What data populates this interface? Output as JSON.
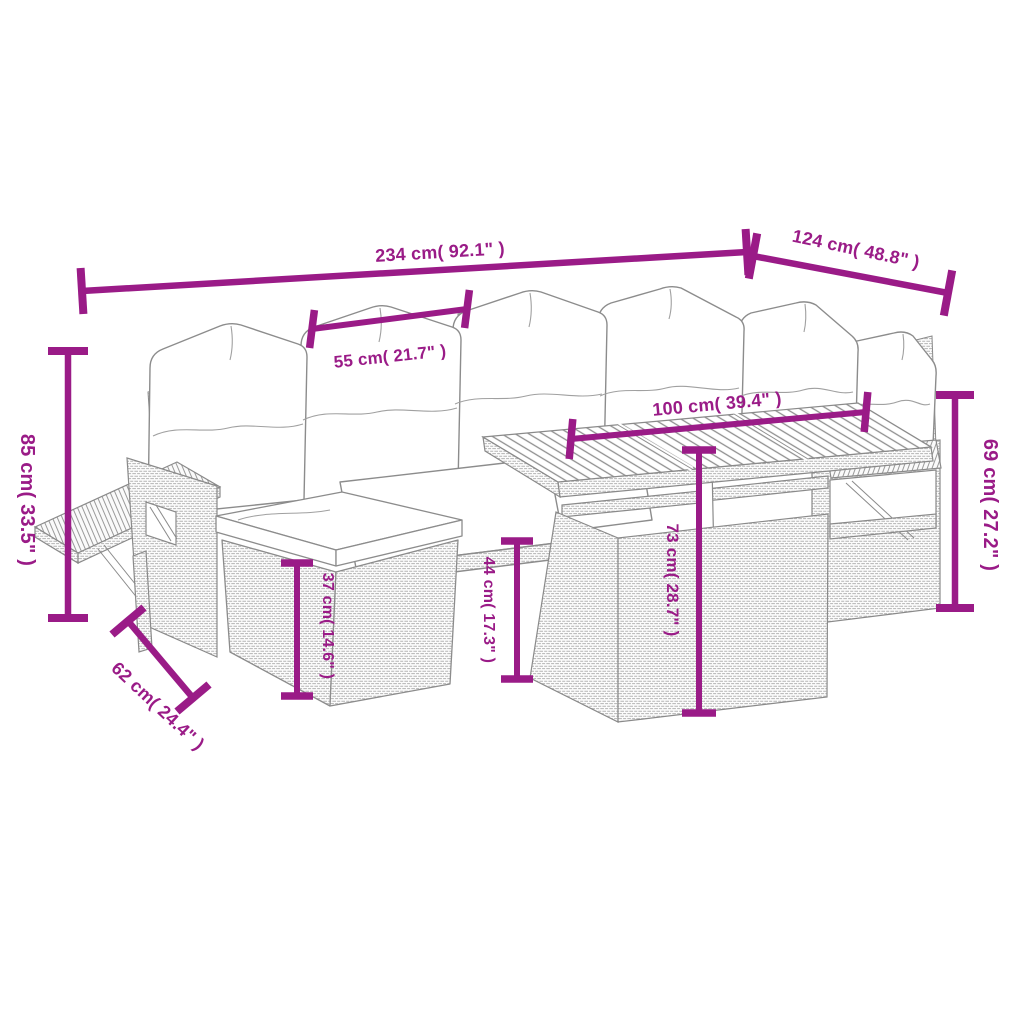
{
  "image": {
    "kind": "product dimension diagram",
    "subject": "line drawing of a poly rattan garden lounge set with back cushions, seat cushions, footstool and wood-slat table",
    "background_color": "#ffffff",
    "line_art_color": "#8a8a8a",
    "accent_color": "#9a1b87"
  },
  "dimensions": [
    {
      "name": "overall-width",
      "label": "234 cm( 92.1\" )"
    },
    {
      "name": "overall-depth",
      "label": "124 cm( 48.8\" )"
    },
    {
      "name": "seat-width",
      "label": "55 cm( 21.7\" )"
    },
    {
      "name": "table-length",
      "label": "100 cm( 39.4\" )"
    },
    {
      "name": "back-height",
      "label": "85 cm( 33.5\" )"
    },
    {
      "name": "arm-height",
      "label": "69 cm( 27.2\" )"
    },
    {
      "name": "footstool-height",
      "label": "37 cm( 14.6\" )"
    },
    {
      "name": "seat-height",
      "label": "44 cm( 17.3\" )"
    },
    {
      "name": "table-height",
      "label": "73 cm( 28.7\" )"
    },
    {
      "name": "footstool-depth",
      "label": "62 cm( 24.4\" )"
    }
  ]
}
